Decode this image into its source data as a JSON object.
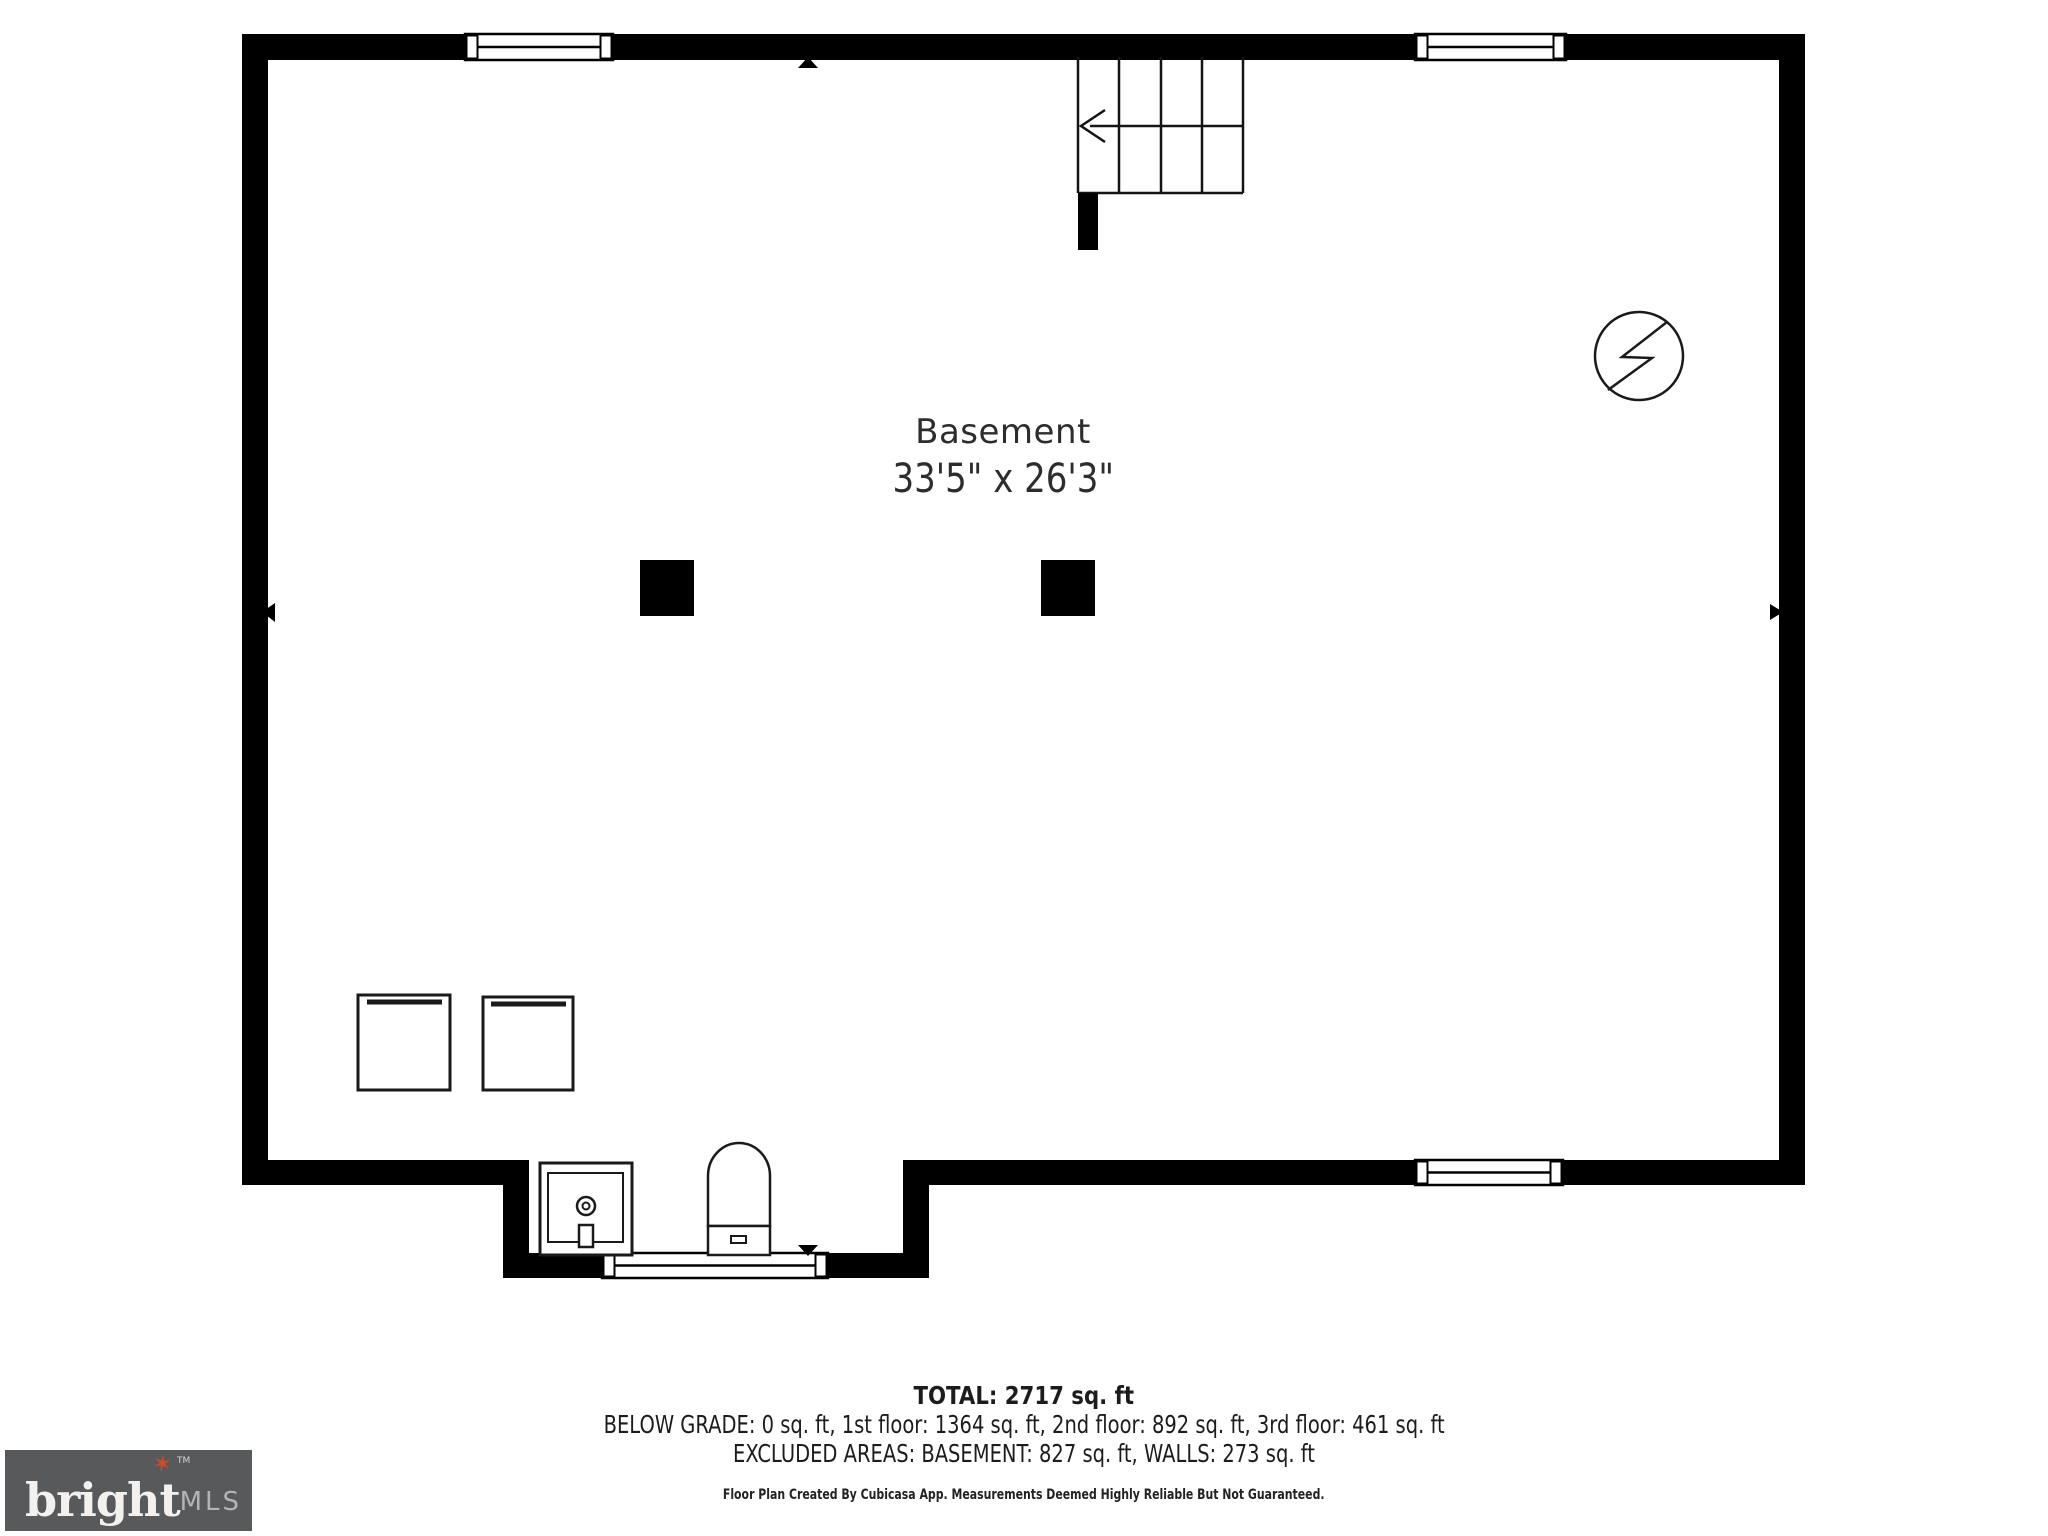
{
  "room": {
    "label": "Basement",
    "dims": "33'5\" x 26'3\""
  },
  "summary": {
    "total": "TOTAL: 2717 sq. ft",
    "floors": "BELOW GRADE: 0 sq. ft, 1st floor: 1364 sq. ft, 2nd floor: 892 sq. ft, 3rd floor: 461 sq. ft",
    "excluded": "EXCLUDED AREAS: BASEMENT: 827 sq. ft, WALLS: 273 sq. ft",
    "disclaimer": "Floor Plan Created By Cubicasa App. Measurements Deemed Highly Reliable But Not Guaranteed."
  },
  "logo": {
    "brand": "bright",
    "tm": "TM",
    "suffix": "MLS",
    "background": "#58595b",
    "accent": "#cf4a28"
  },
  "colors": {
    "wall": "#000000",
    "line": "#141414",
    "text": "#2d2d2d"
  },
  "icons": {
    "stair_arrow": "arrow-left",
    "utility_symbol": "circle-lightning",
    "markers": [
      "triangle-up",
      "triangle-left",
      "triangle-right",
      "triangle-down"
    ]
  }
}
